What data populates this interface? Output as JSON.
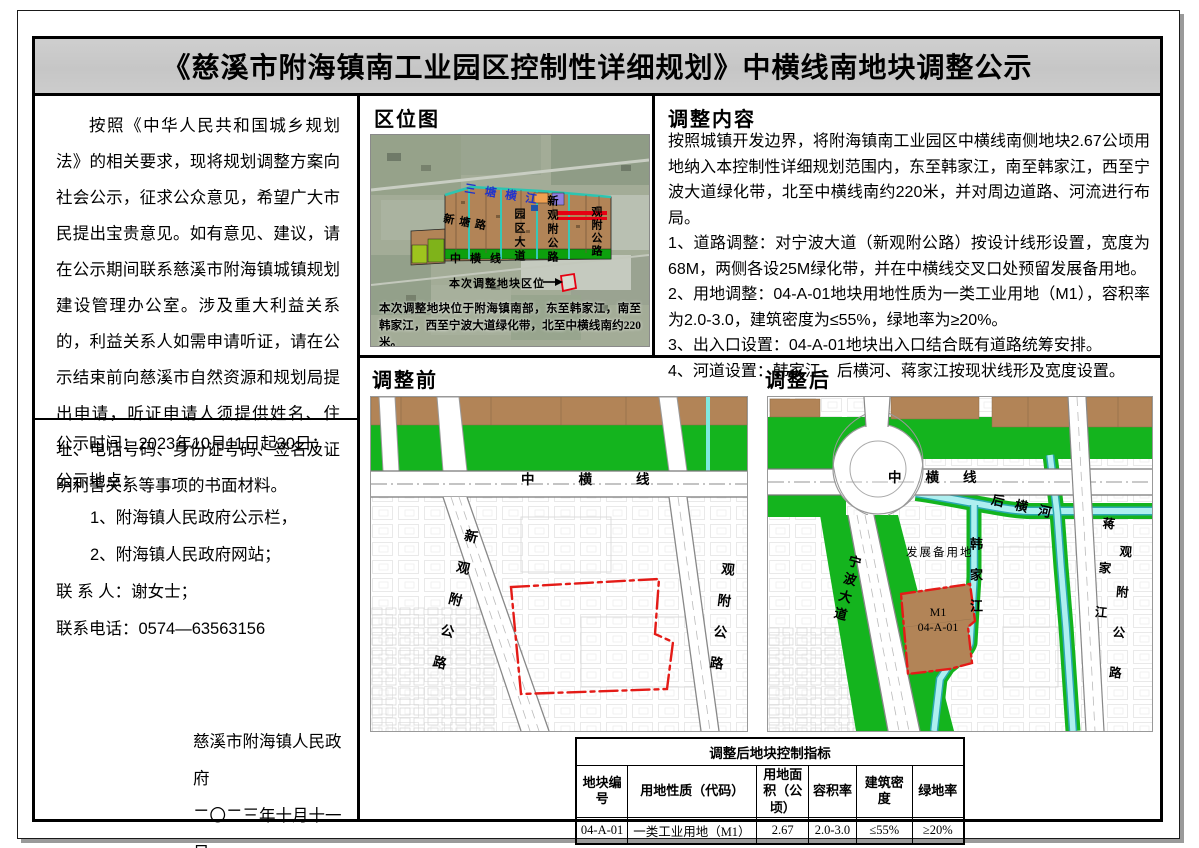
{
  "page": {
    "title": "《慈溪市附海镇南工业园区控制性详细规划》中横线南地块调整公示"
  },
  "left_panel": {
    "paragraph": "按照《中华人民共和国城乡规划法》的相关要求，现将规划调整方案向社会公示，征求公众意见，希望广大市民提出宝贵意见。如有意见、建议，请在公示期间联系慈溪市附海镇城镇规划建设管理办公室。涉及重大利益关系的，利益关系人如需申请听证，请在公示结束前向慈溪市自然资源和规划局提出申请，听证申请人须提供姓名、住址、电话号码、身份证号码、签名及证明利害关系等事项的书面材料。",
    "notice_time": "公示时间：2023年10月11日起30日；",
    "notice_place_label": "公示地点：",
    "notice_place_1": "1、附海镇人民政府公示栏，",
    "notice_place_2": "2、附海镇人民政府网站；",
    "contact_person": "联 系 人：谢女士；",
    "contact_phone": "联系电话：0574—63563156",
    "signature_org": "慈溪市附海镇人民政府",
    "signature_date": "二〇二三年十月十一日"
  },
  "location_map": {
    "heading": "区位图",
    "river_label": "三塘横江",
    "road_xintang": "新塘路",
    "road_yuanqu": "园区大道",
    "road_xinguanfu": "新观附公路",
    "road_guanfu": "观附公路",
    "road_zhongheng": "中横线",
    "callout": "本次调整地块区位",
    "caption": "本次调整地块位于附海镇南部，东至韩家江，南至韩家江，西至宁波大道绿化带，北至中横线南约220米。"
  },
  "adjustment": {
    "heading": "调整内容",
    "intro": "按照城镇开发边界，将附海镇南工业园区中横线南侧地块2.67公顷用地纳入本控制性详细规划范围内，东至韩家江，南至韩家江，西至宁波大道绿化带，北至中横线南约220米，并对周边道路、河流进行布局。",
    "items": [
      "1、道路调整：对宁波大道（新观附公路）按设计线形设置，宽度为68M，两侧各设25M绿化带，并在中横线交叉口处预留发展备用地。",
      "2、用地调整：04-A-01地块用地性质为一类工业用地（M1），容积率为2.0-3.0，建筑密度为≤55%，绿地率为≥20%。",
      "3、出入口设置：04-A-01地块出入口结合既有道路统筹安排。",
      "4、河道设置：韩家江、后横河、蒋家江按现状线形及宽度设置。"
    ]
  },
  "before_map": {
    "heading": "调整前",
    "road_zhongheng": "中横线",
    "road_xinguanfu": "新观附公路",
    "road_guanfu": "观附公路"
  },
  "after_map": {
    "heading": "调整后",
    "road_zhongheng": "中横线",
    "river_houheng": "后横河",
    "road_ningbo": "宁波大道",
    "river_hanjia": "韩家江",
    "river_jiangjia": "蒋家江",
    "road_guanfu": "观附公路",
    "reserve_label": "发展备用地",
    "plot_use": "M1",
    "plot_id": "04-A-01"
  },
  "table": {
    "title": "调整后地块控制指标",
    "headers": [
      "地块编号",
      "用地性质（代码）",
      "用地面积（公顷）",
      "容积率",
      "建筑密度",
      "绿地率"
    ],
    "row": [
      "04-A-01",
      "一类工业用地（M1）",
      "2.67",
      "2.0-3.0",
      "≤55%",
      "≥20%"
    ]
  },
  "colors": {
    "title_band": "#c9c9c9",
    "plan_green": "#14b41e",
    "plot_brown": "#b28457",
    "river_cyan": "#aeeff0",
    "boundary_red": "#e41b17"
  }
}
